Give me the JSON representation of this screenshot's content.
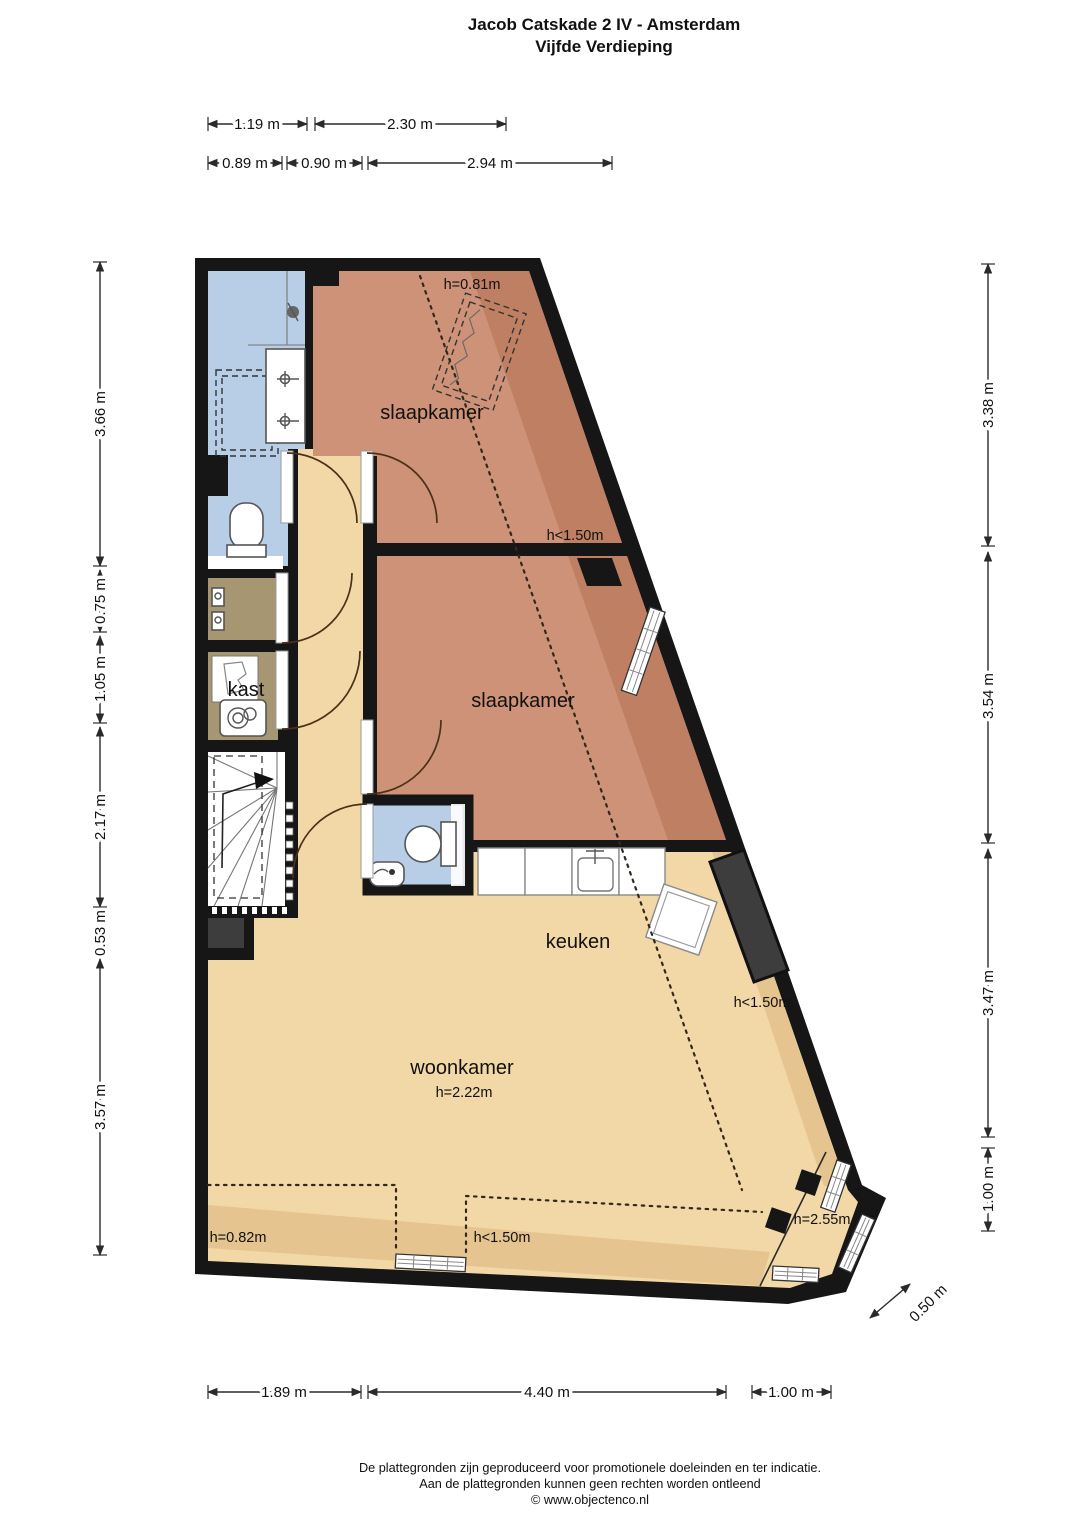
{
  "title": {
    "line1": "Jacob Catskade 2 IV - Amsterdam",
    "line2": "Vijfde Verdieping"
  },
  "rooms": {
    "bedroom_top": {
      "label": "slaapkamer",
      "ceiling_note": "h=0.81m",
      "low_ceiling_note": "h<1.50m"
    },
    "bedroom_middle": {
      "label": "slaapkamer"
    },
    "kitchen": {
      "label": "keuken",
      "low_ceiling_note": "h<1.50m"
    },
    "living_room": {
      "label": "woonkamer",
      "ceiling_note": "h=2.22m",
      "low_ceiling_left": "h=0.82m",
      "low_ceiling_mid": "h<1.50m",
      "bay_note": "h=2.55m"
    },
    "closet": {
      "label": "kast"
    }
  },
  "dimensions": {
    "top_row1": [
      "1.19 m",
      "2.30 m"
    ],
    "top_row2": [
      "0.89 m",
      "0.90 m",
      "2.94 m"
    ],
    "left": [
      "3.66 m",
      "0.75 m",
      "1.05 m",
      "2.17 m",
      "0.53 m",
      "3.57 m"
    ],
    "right": [
      "3.38 m",
      "3.54 m",
      "3.47 m",
      "1.00 m"
    ],
    "bay": "0.50 m",
    "bottom": [
      "1.89 m",
      "4.40 m",
      "1.00 m"
    ]
  },
  "footer": {
    "line1": "De plattegronden zijn geproduceerd voor promotionele doeleinden en ter indicatie.",
    "line2": "Aan de plattegronden kunnen geen rechten worden ontleend",
    "line3": "© www.objectenco.nl"
  },
  "colors": {
    "wall": "#161616",
    "floor": "#f2d8a6",
    "floor_shade": "#e5c48f",
    "bedroom": "#cd9277",
    "bedroom_shade": "#bf7f63",
    "bath": "#b7cee6",
    "closet": "#a79672",
    "stairs": "#ffffff",
    "chimney": "#3d3d3d"
  }
}
